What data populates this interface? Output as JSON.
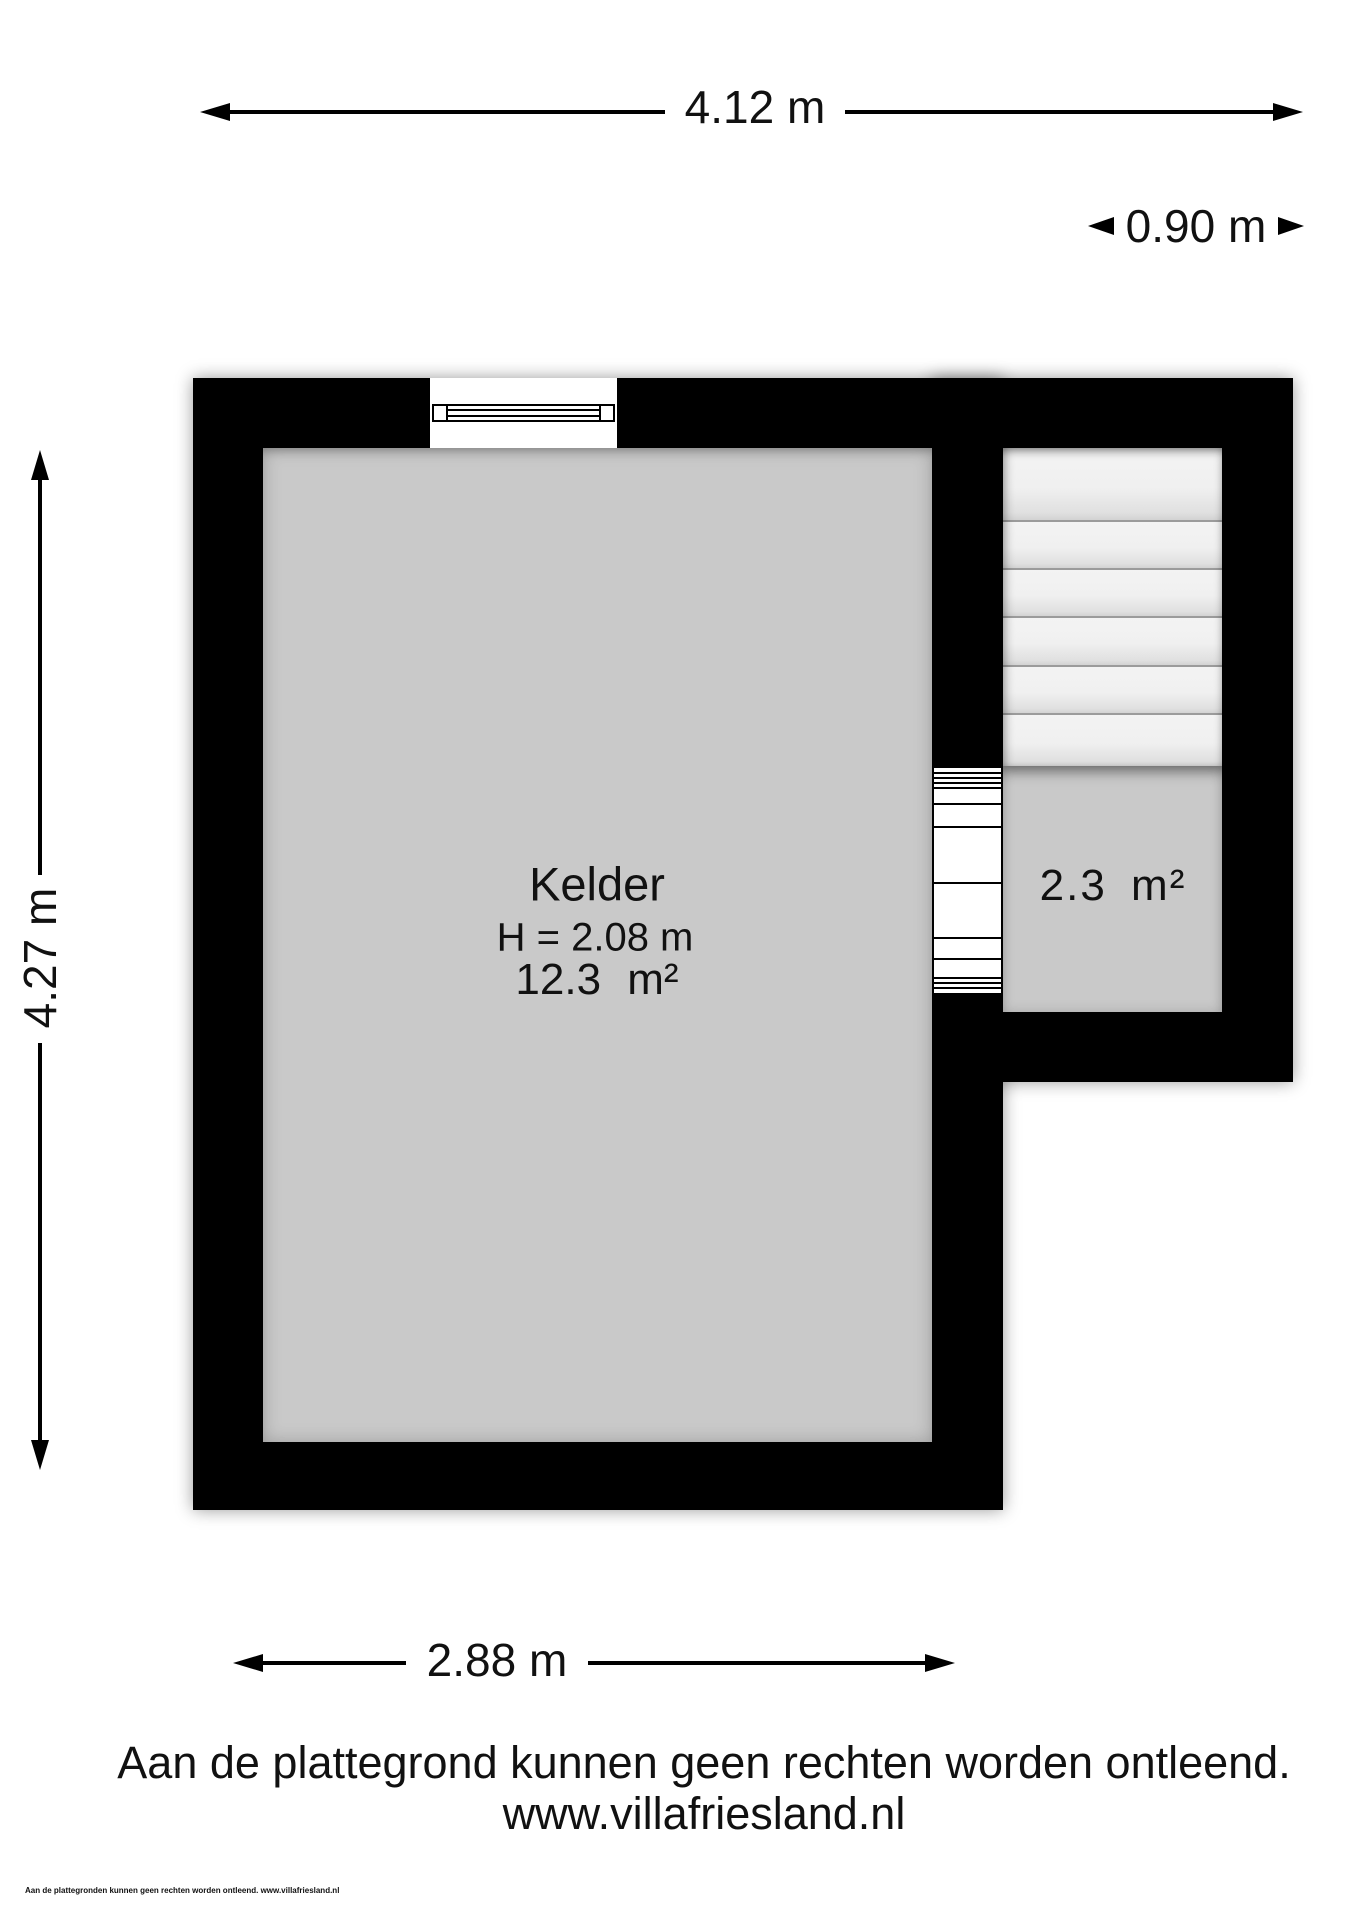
{
  "plan": {
    "rooms": {
      "kelder": {
        "label": "Kelder",
        "height_label": "H = 2.08 m",
        "area_label": "12.3 m²"
      },
      "stair_room": {
        "area_label": "2.3 m²"
      }
    },
    "dimensions": {
      "overall_width": "4.12 m",
      "stair_width": "0.90 m",
      "overall_height": "4.27 m",
      "room_width": "2.88 m"
    }
  },
  "footer": {
    "disclaimer": "Aan de plattegrond kunnen geen rechten worden ontleend.",
    "website": "www.villafriesland.nl",
    "fine_print": "Aan de plattegronden kunnen geen rechten worden ontleend. www.villafriesland.nl"
  },
  "colors": {
    "wall": "#000000",
    "room_fill": "#c9c9c9",
    "stair_tread": "#f1f1f1",
    "background": "#ffffff",
    "text": "#111111"
  }
}
